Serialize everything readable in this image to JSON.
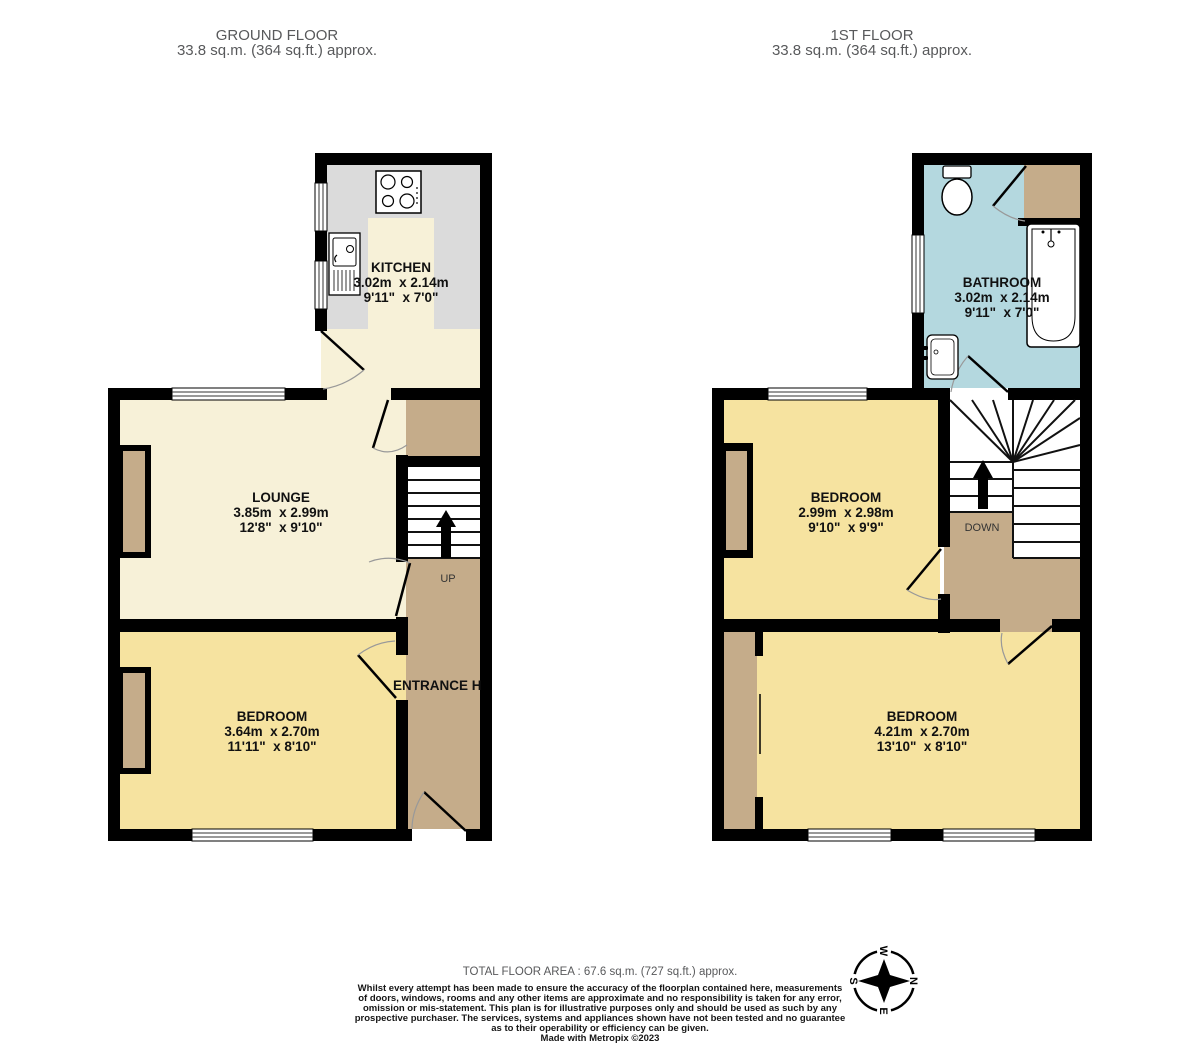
{
  "colors": {
    "wall": "#000000",
    "floor_cream": "#f7f1d8",
    "floor_yellow": "#f6e3a0",
    "floor_tan": "#c5ac8a",
    "counter_gray": "#dbdbdb",
    "bathroom_blue": "#b4d8df",
    "title_gray": "#58595b"
  },
  "ground_floor": {
    "title": "GROUND FLOOR",
    "subtitle": "33.8 sq.m. (364 sq.ft.) approx.",
    "kitchen": {
      "name": "KITCHEN",
      "metric": "3.02m  x 2.14m",
      "imperial": "9'11\"  x 7'0\""
    },
    "lounge": {
      "name": "LOUNGE",
      "metric": "3.85m  x 2.99m",
      "imperial": "12'8\"  x 9'10\""
    },
    "bedroom": {
      "name": "BEDROOM",
      "metric": "3.64m  x 2.70m",
      "imperial": "11'11\"  x 8'10\""
    },
    "hall": {
      "name": "ENTRANCE HALL"
    },
    "stairs_label": "UP"
  },
  "first_floor": {
    "title": "1ST FLOOR",
    "subtitle": "33.8 sq.m. (364 sq.ft.) approx.",
    "bathroom": {
      "name": "BATHROOM",
      "metric": "3.02m  x 2.14m",
      "imperial": "9'11\"  x 7'0\""
    },
    "bedroom1": {
      "name": "BEDROOM",
      "metric": "2.99m  x 2.98m",
      "imperial": "9'10\"  x 9'9\""
    },
    "bedroom2": {
      "name": "BEDROOM",
      "metric": "4.21m  x 2.70m",
      "imperial": "13'10\"  x 8'10\""
    },
    "stairs_label": "DOWN"
  },
  "footer": {
    "total_area": "TOTAL FLOOR AREA : 67.6 sq.m. (727 sq.ft.) approx.",
    "disclaimer_lines": [
      "Whilst every attempt has been made to ensure the accuracy of the floorplan contained here, measurements",
      "of doors, windows, rooms and any other items are approximate and no responsibility is taken for any error,",
      "omission or mis-statement. This plan is for illustrative purposes only and should be used as such by any",
      "prospective purchaser. The services, systems and appliances shown have not been tested and no guarantee",
      "as to their operability or efficiency can be given."
    ],
    "credit": "Made with Metropix ©2023"
  },
  "compass": {
    "north": "N",
    "east": "E",
    "south": "S",
    "west": "W"
  }
}
